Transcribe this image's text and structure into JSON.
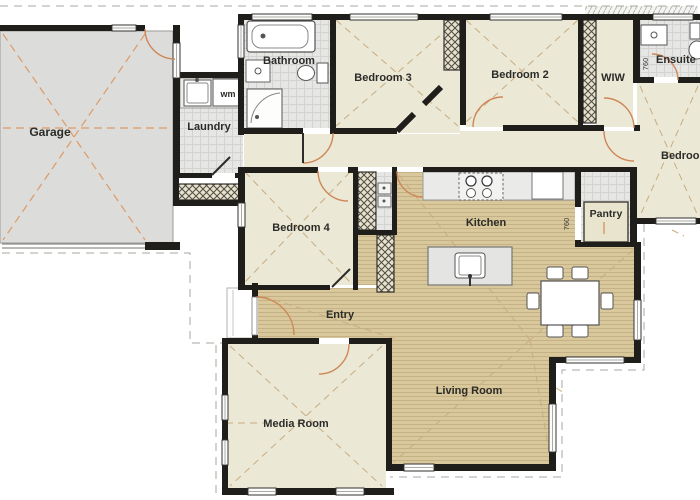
{
  "rooms": {
    "garage": "Garage",
    "laundry": "Laundry",
    "bathroom": "Bathroom",
    "bedroom3": "Bedroom 3",
    "bedroom2": "Bedroom 2",
    "wiw": "WIW",
    "ensuite": "Ensuite",
    "master_bedroom": "Bedroom",
    "bedroom4": "Bedroom 4",
    "kitchen": "Kitchen",
    "pantry": "Pantry",
    "entry": "Entry",
    "living_room": "Living Room",
    "media_room": "Media Room"
  },
  "fixtures": {
    "washing_machine": "wm"
  },
  "dimensions": {
    "pantry_door": "760",
    "ensuite_door": "760"
  },
  "colors": {
    "wall": "#201e1b",
    "carpet_floor": "#ebe8d6",
    "timber_floor": "#d8c89c",
    "tile_floor": "#e6e6e5",
    "garage_floor": "#dcdcda",
    "door_swing": "#cf8757",
    "truss_line": "#c8ac80",
    "setout_line": "#de9a66",
    "eave_line": "#a7a7a2"
  }
}
